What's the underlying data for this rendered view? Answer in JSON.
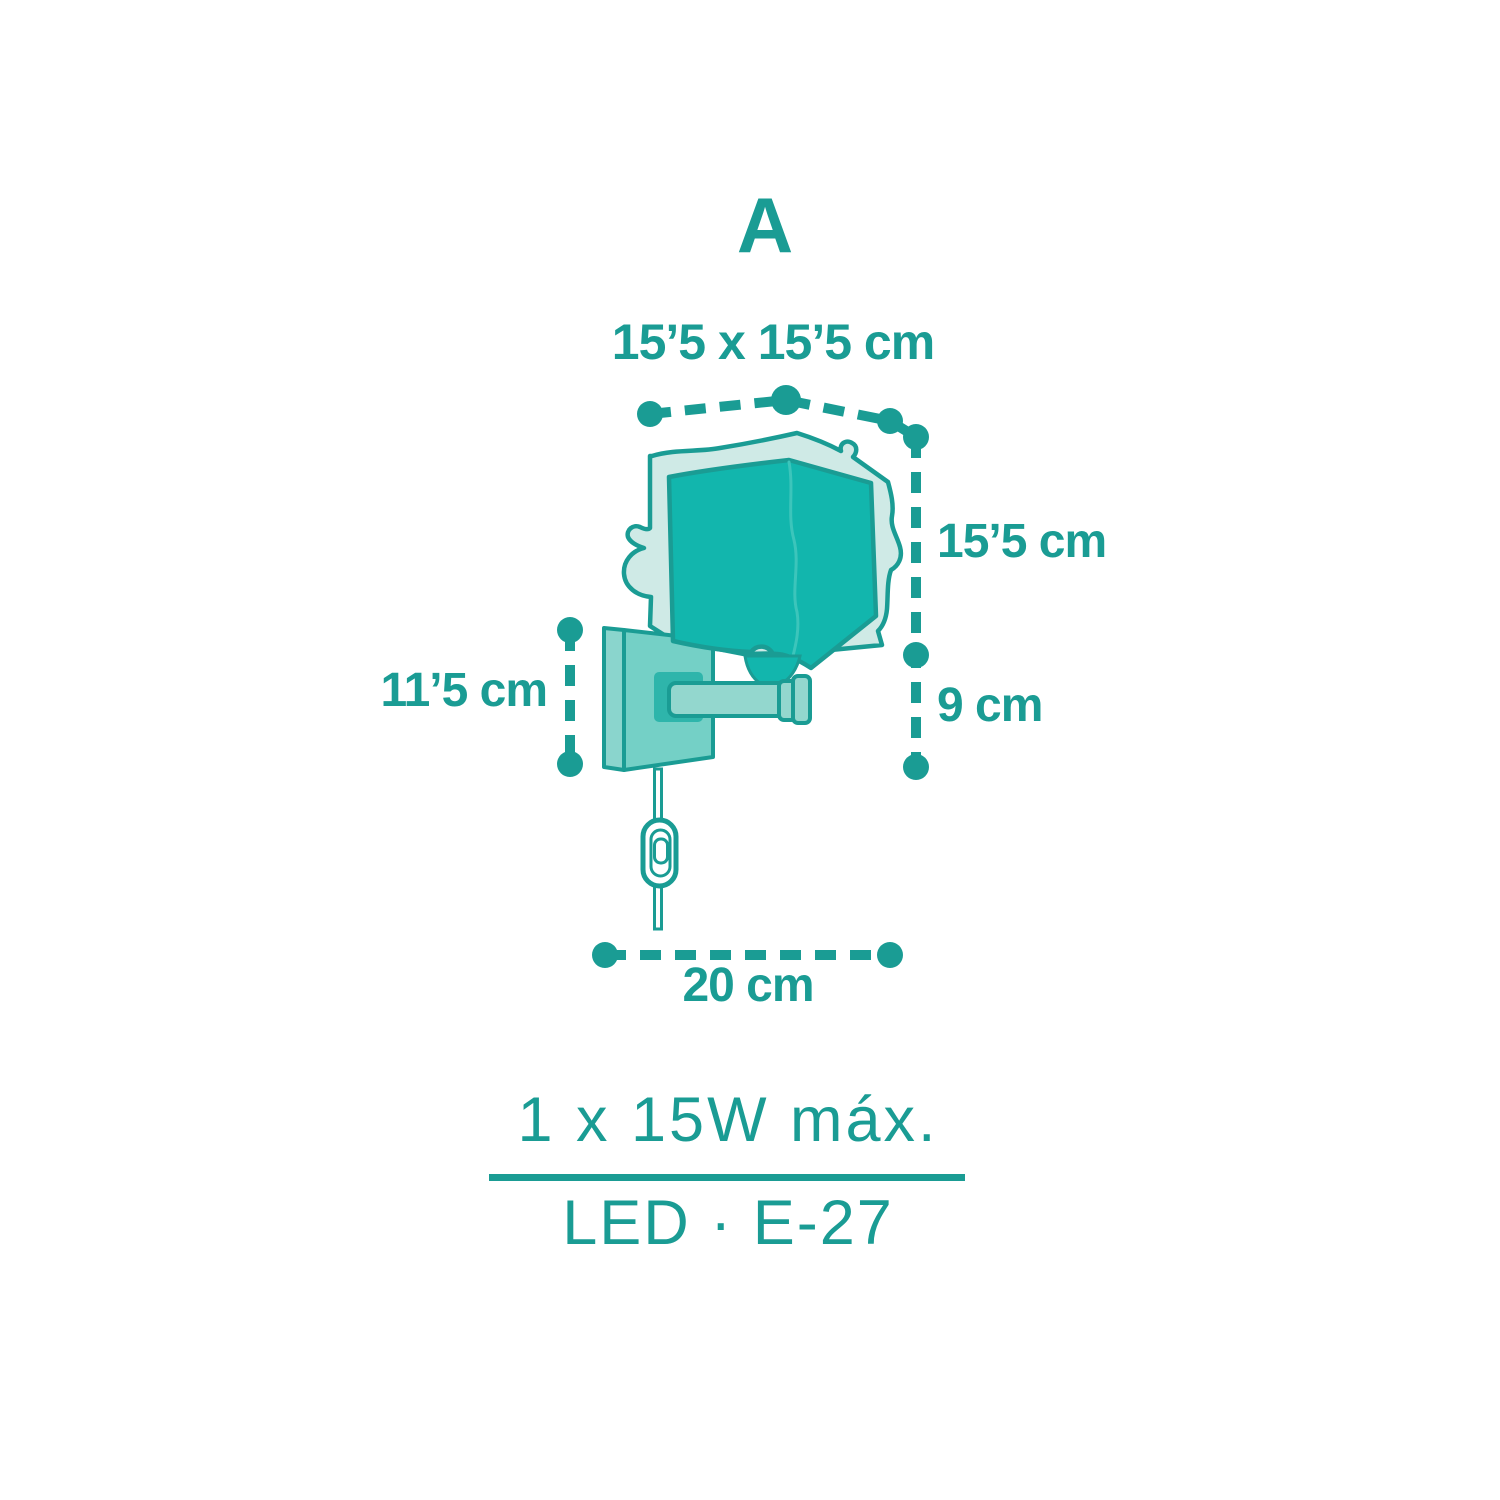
{
  "diagram": {
    "panel_label": "A",
    "dimensions": {
      "shade_top": "15’5 x 15’5 cm",
      "shade_height": "15’5 cm",
      "mount_height": "11’5 cm",
      "bottom_clearance": "9 cm",
      "total_width": "20 cm"
    },
    "specs": {
      "max_wattage": "1 x 15W máx.",
      "socket": "LED · E-27"
    },
    "colors": {
      "primary": "#1a9c94",
      "dark-fill": "#12b6ad",
      "light-fill": "#cfeae6",
      "plate-fill": "#74d0c6",
      "plate-edge-fill": "#8ad5cd",
      "arm-fill": "#93d7ce",
      "block-fill": "#2eb5ab",
      "fold-line": "#3cc5bb",
      "background": "#ffffff"
    }
  }
}
